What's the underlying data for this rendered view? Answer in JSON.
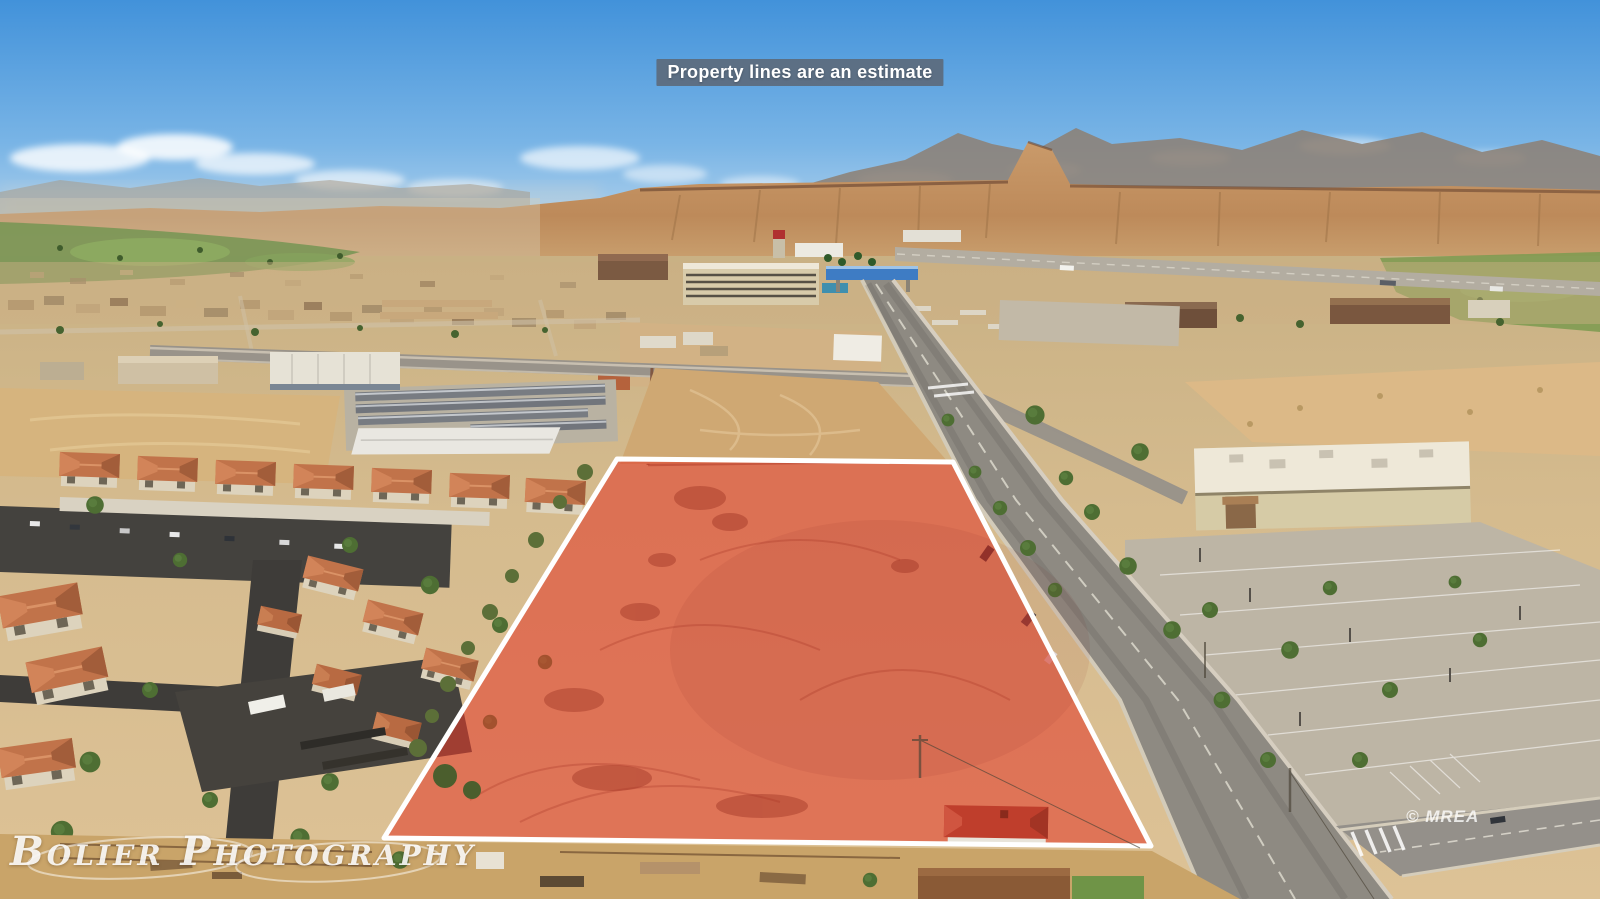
{
  "banner": {
    "text": "Property lines are an estimate"
  },
  "watermarks": {
    "photographer": "Bolier Photography",
    "copyright": "© MREA"
  },
  "colors": {
    "sky_top": "#4292da",
    "sky_horizon": "#cfe3f2",
    "mesa": "#c08c5e",
    "desert_floor": "#d9bf92",
    "vegetation": "#6b8b3f",
    "asphalt_road": "#8e8a82",
    "roof_terracotta": "#c1734a",
    "parcel_fill": "#e23c2b",
    "parcel_outline": "#ffffff",
    "banner_bg": "#5c6674",
    "banner_text": "#ffffff",
    "watermark_text": "#ffffff"
  }
}
